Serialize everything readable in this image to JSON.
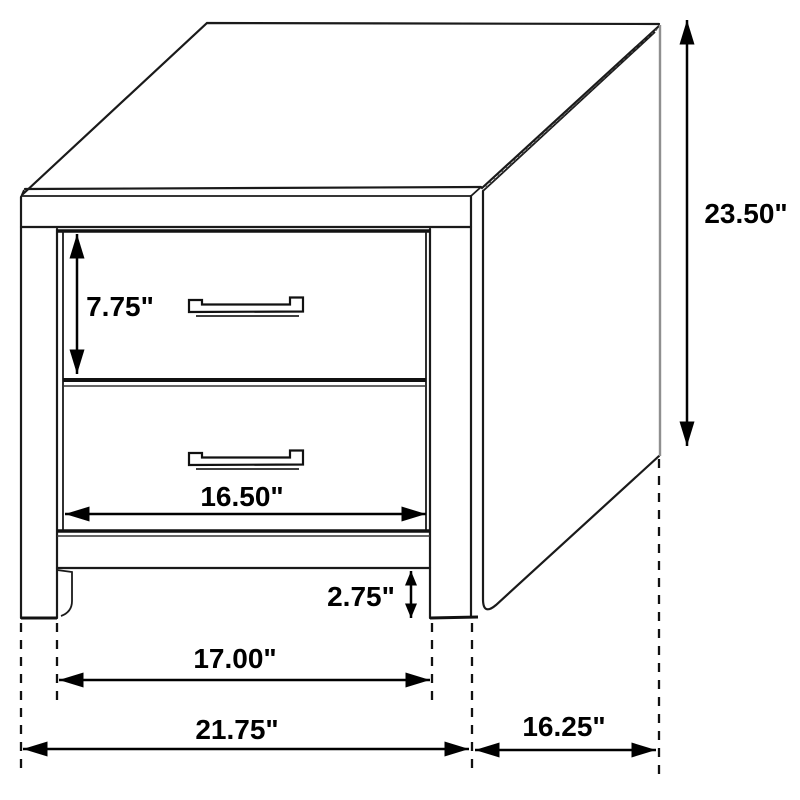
{
  "diagram": {
    "name": "2-Drawer Nightstand Dimension Diagram",
    "object": "nightstand line drawing with two drawers",
    "units": "inches",
    "colors": {
      "line": "#1a1a1a",
      "label": "#000000",
      "background": "#ffffff",
      "soft_edge": "#8f8f8f"
    },
    "dimensions": {
      "overall_height": "23.50\"",
      "top_drawer_height": "7.75\"",
      "drawer_opening_width": "16.50\"",
      "leg_height": "2.75\"",
      "between_legs_width": "17.00\"",
      "overall_width": "21.75\"",
      "depth": "16.25\""
    }
  }
}
